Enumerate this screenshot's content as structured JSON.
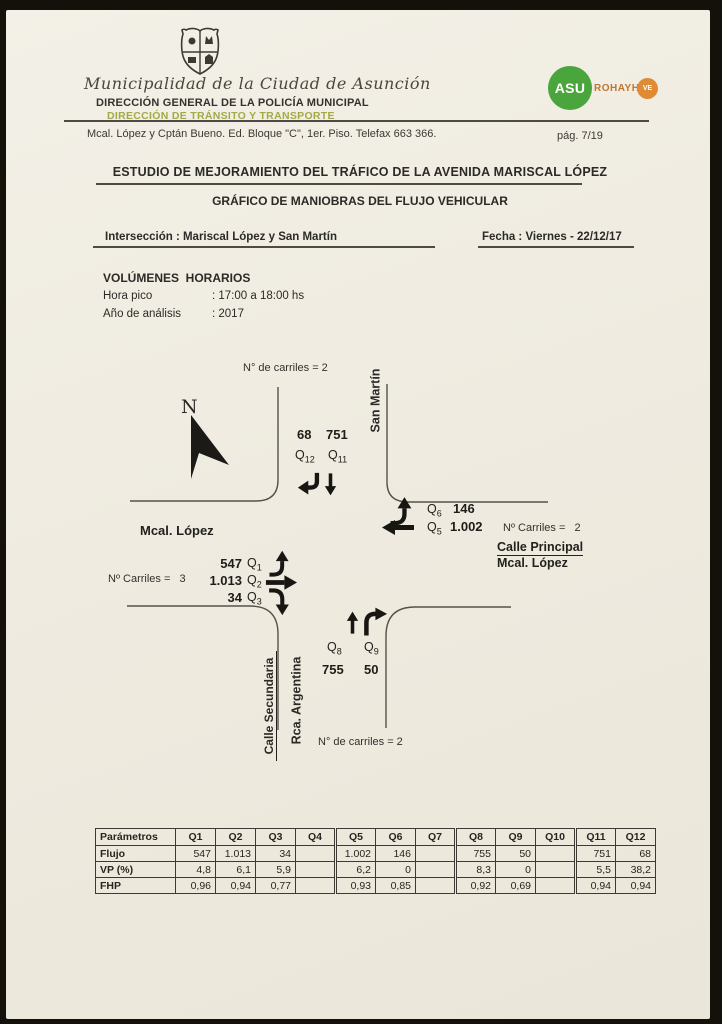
{
  "header": {
    "municipality": "Municipalidad de la Ciudad de Asunción",
    "direccion_general": "DIRECCIÓN GENERAL DE LA POLICÍA MUNICIPAL",
    "direccion_transito": "DIRECCIÓN DE TRÁNSITO Y TRANSPORTE",
    "address": "Mcal. López y Cptán Bueno. Ed. Bloque \"C\", 1er. Piso. Telefax 663 366.",
    "page_number": "pág. 7/19",
    "logo": {
      "asu": "ASU",
      "rohayhu": "ROHAYHU",
      "badge": "VE"
    },
    "colors": {
      "transito_green": "#a3aa45",
      "asu_green": "#4aa53c",
      "rohayhu_orange": "#c0762e",
      "badge_orange": "#e08a34"
    }
  },
  "titles": {
    "main": "ESTUDIO DE MEJORAMIENTO DEL TRÁFICO DE LA AVENIDA MARISCAL LÓPEZ",
    "subtitle": "GRÁFICO DE MANIOBRAS DEL FLUJO VEHICULAR",
    "intersection": "Intersección : Mariscal López y San Martín",
    "date": "Fecha : Viernes - 22/12/17"
  },
  "volumes": {
    "heading": "VOLÚMENES  HORARIOS",
    "rows": [
      {
        "label": "Hora pico",
        "value": ": 17:00 a 18:00 hs"
      },
      {
        "label": "Año de análisis",
        "value": ": 2017"
      }
    ]
  },
  "diagram": {
    "north": "N",
    "lanes_top": "N° de carriles = 2",
    "lanes_bottom": "N° de carriles = 2",
    "lanes_left": "Nº Carriles =   3",
    "lanes_right": "Nº Carriles =   2",
    "street_top": "San Martín",
    "street_left": "Mcal. López",
    "street_right_line1": "Calle Principal",
    "street_right_line2": "Mcal. López",
    "street_bottom_line1": "Calle Secundaria",
    "street_bottom_line2": "Rca. Argentina",
    "movements": {
      "q1": {
        "label": "Q",
        "sub": "1",
        "value": "547"
      },
      "q2": {
        "label": "Q",
        "sub": "2",
        "value": "1.013"
      },
      "q3": {
        "label": "Q",
        "sub": "3",
        "value": "34"
      },
      "q5": {
        "label": "Q",
        "sub": "5",
        "value": "1.002"
      },
      "q6": {
        "label": "Q",
        "sub": "6",
        "value": "146"
      },
      "q8": {
        "label": "Q",
        "sub": "8",
        "value": "755"
      },
      "q9": {
        "label": "Q",
        "sub": "9",
        "value": "50"
      },
      "q11": {
        "label": "Q",
        "sub": "11",
        "value": "751"
      },
      "q12": {
        "label": "Q",
        "sub": "12",
        "value": "68"
      }
    }
  },
  "table": {
    "header": [
      "Parámetros",
      "Q1",
      "Q2",
      "Q3",
      "Q4",
      "Q5",
      "Q6",
      "Q7",
      "Q8",
      "Q9",
      "Q10",
      "Q11",
      "Q12"
    ],
    "rows": [
      {
        "label": "Flujo",
        "values": [
          "547",
          "1.013",
          "34",
          "",
          "1.002",
          "146",
          "",
          "755",
          "50",
          "",
          "751",
          "68"
        ]
      },
      {
        "label": "VP (%)",
        "values": [
          "4,8",
          "6,1",
          "5,9",
          "",
          "6,2",
          "0",
          "",
          "8,3",
          "0",
          "",
          "5,5",
          "38,2"
        ]
      },
      {
        "label": "FHP",
        "values": [
          "0,96",
          "0,94",
          "0,77",
          "",
          "0,93",
          "0,85",
          "",
          "0,92",
          "0,69",
          "",
          "0,94",
          "0,94"
        ]
      }
    ]
  }
}
